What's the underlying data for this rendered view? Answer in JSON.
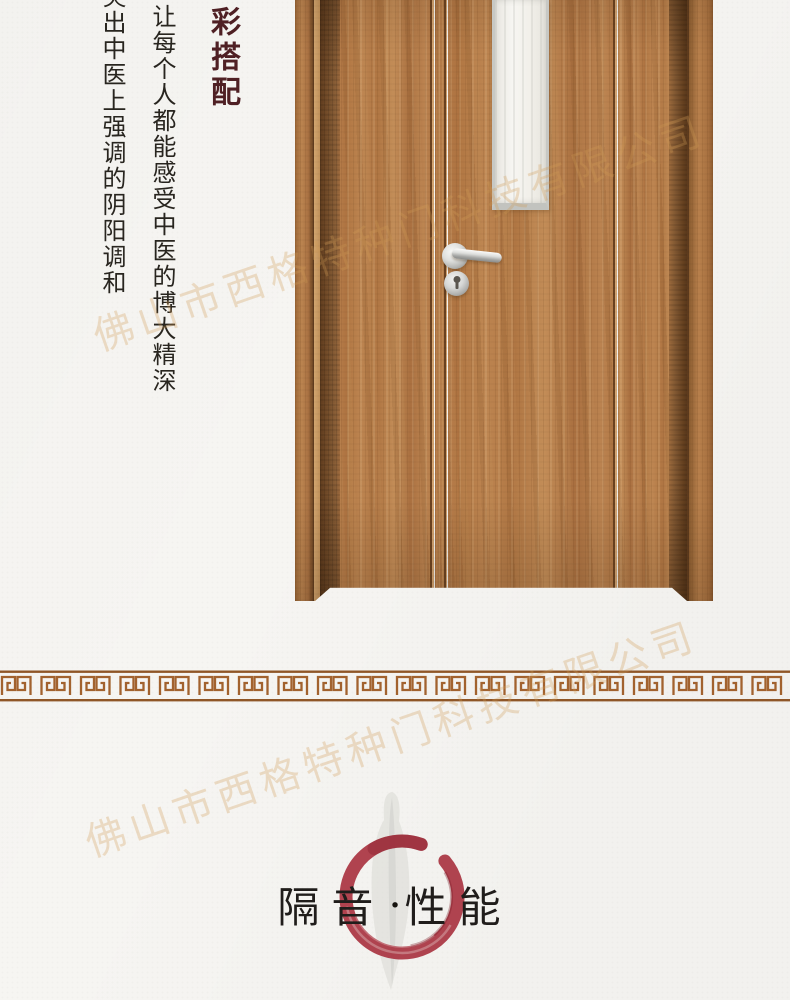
{
  "page": {
    "background_color": "#f6f5f2"
  },
  "intro_text": {
    "subtitle_vertical": "彩搭配",
    "subtitle_color": "#4f2024",
    "body_column_right": "让每个人都能感受中医的博大精深",
    "body_column_left": "突出中医上强调的阴阳调和",
    "body_color": "#28251f"
  },
  "watermark": {
    "text": "佛山市西格特种门科技有限公司",
    "color": "#cf9a55"
  },
  "door_illustration": {
    "wood_color": "#b57c48",
    "dark_band_color": "#6f4826",
    "glass_color": "#f3f2ee",
    "hardware_color": "#c6c7c5"
  },
  "divider": {
    "pattern": "greek-key-meander",
    "color": "#a2622e",
    "line_color": "#8f5627"
  },
  "section_title": {
    "left": "隔音",
    "separator": "·",
    "right": "性能",
    "text_color": "#201d1b",
    "enso_color": "#a93441"
  }
}
